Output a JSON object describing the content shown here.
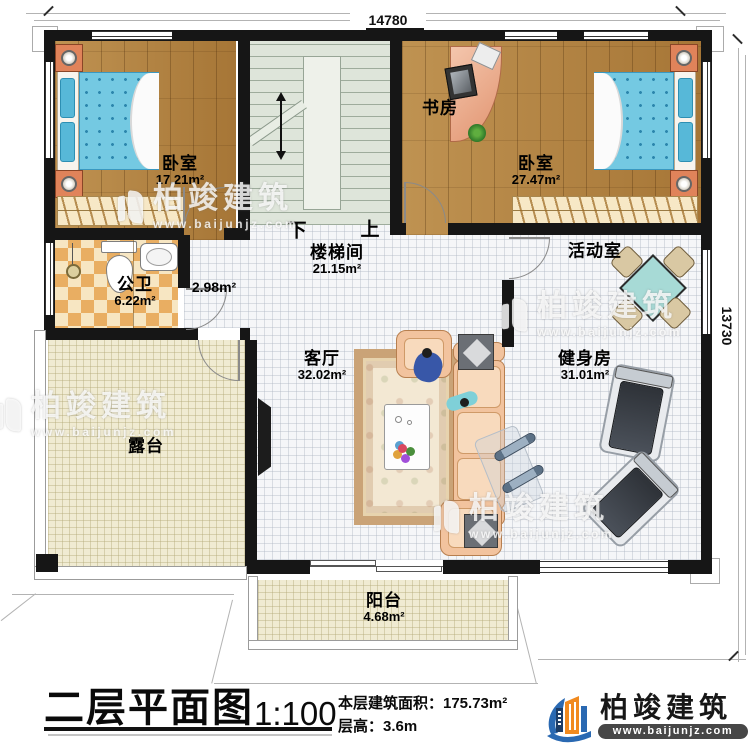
{
  "plan": {
    "dimensions": {
      "top": "14780",
      "right": "13730"
    },
    "stairs": {
      "down": "下",
      "up": "上"
    },
    "rooms": {
      "bedroom1": {
        "name": "卧室",
        "area": "17.21m²"
      },
      "study": {
        "name": "书房"
      },
      "bedroom2": {
        "name": "卧室",
        "area": "27.47m²"
      },
      "bathroom": {
        "name": "公卫",
        "area": "6.22m²"
      },
      "hallway": {
        "area": "2.98m²"
      },
      "stairwell": {
        "name": "楼梯间",
        "area": "21.15m²"
      },
      "activity": {
        "name": "活动室"
      },
      "living": {
        "name": "客厅",
        "area": "32.02m²"
      },
      "gym": {
        "name": "健身房",
        "area": "31.01m²"
      },
      "terrace": {
        "name": "露台"
      },
      "balcony": {
        "name": "阳台",
        "area": "4.68m²"
      }
    }
  },
  "title_block": {
    "title": "二层平面图",
    "scale": "1:100",
    "area_line": "本层建筑面积：175.73m²",
    "height_line": "层高：3.6m"
  },
  "brand": {
    "name": "柏竣建筑",
    "site": "www.baijunjz.com"
  },
  "watermark": {
    "name": "柏竣建筑",
    "site": "www.baijunjz.com"
  },
  "colors": {
    "brand_orange": "#f18a1f",
    "brand_blue": "#2a69b2",
    "wall_black": "#161616"
  }
}
